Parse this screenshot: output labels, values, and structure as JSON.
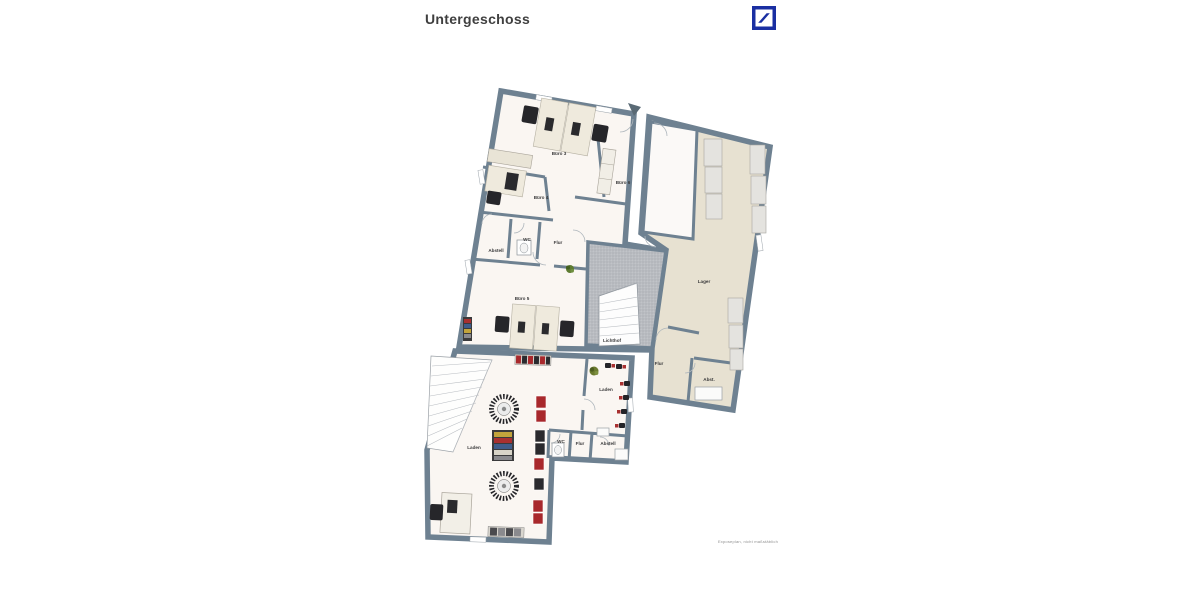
{
  "header": {
    "title": "Untergeschoss"
  },
  "logo": {
    "icon": "deutsche-bank-slash-logo"
  },
  "footer": {
    "disclaimer": "Exposeplan, nicht maßstäblich"
  },
  "colors": {
    "brand_blue": "#1a2fa2",
    "wall": "#6e8191",
    "floor_light": "#faf6f2",
    "floor_white_room": "#fbf9f7",
    "floor_beige": "#e7e1d1",
    "lichthof_gray": "#b9bcc1",
    "furniture_beige": "#efeadd",
    "furniture_dark": "#26262a",
    "accent_red": "#a8282c",
    "plant_green": "#5d7b31",
    "title_text": "#3f3f3f",
    "label_text": "#3b3b3c"
  },
  "plan": {
    "rooms": {
      "buero3": "Büro 3",
      "buero4": "Büro 4",
      "buero5": "Büro 5",
      "buero6": "Büro 6",
      "abstell_upper": "Abstell",
      "wc_upper": "WC",
      "flur_upper": "Flur",
      "lichthof": "Lichthof",
      "lager": "Lager",
      "flur_mid": "Flur",
      "abst": "Abst.",
      "laden_right": "Laden",
      "laden_main": "Laden",
      "wc_lower": "WC",
      "flur_lower": "Flur",
      "abstell_lower": "Abstell"
    }
  }
}
